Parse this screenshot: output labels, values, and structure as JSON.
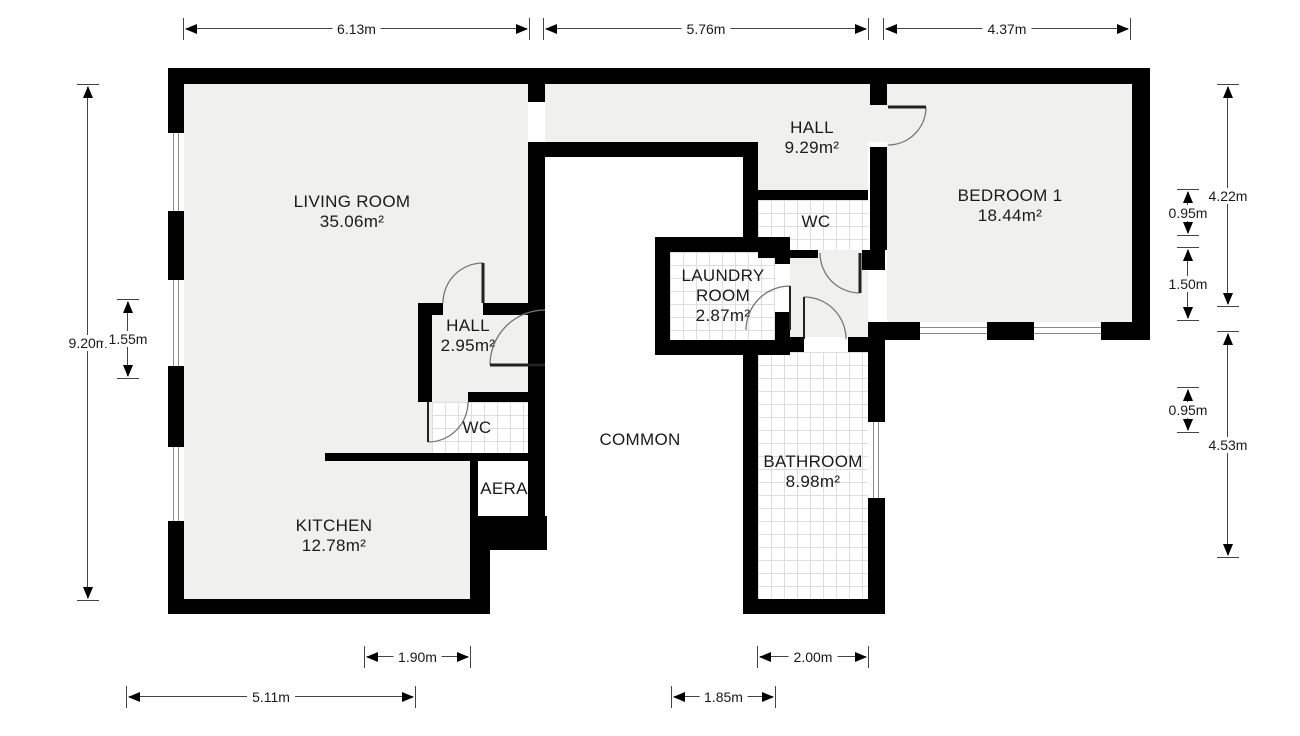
{
  "title": "Apartment floor plan",
  "rooms": [
    {
      "name": "LIVING ROOM",
      "lines": [
        "LIVING ROOM",
        "35.06m²"
      ],
      "x": 352,
      "y": 212
    },
    {
      "name": "HALL",
      "lines": [
        "HALL",
        "9.29m²"
      ],
      "x": 812,
      "y": 138
    },
    {
      "name": "BEDROOM 1",
      "lines": [
        "BEDROOM 1",
        "18.44m²"
      ],
      "x": 1010,
      "y": 206
    },
    {
      "name": "WC",
      "lines": [
        "WC"
      ],
      "x": 816,
      "y": 222
    },
    {
      "name": "LAUNDRY ROOM",
      "lines": [
        "LAUNDRY",
        "ROOM",
        "2.87m²"
      ],
      "x": 723,
      "y": 296
    },
    {
      "name": "HALL",
      "lines": [
        "HALL",
        "2.95m²"
      ],
      "x": 468,
      "y": 336
    },
    {
      "name": "WC",
      "lines": [
        "WC"
      ],
      "x": 477,
      "y": 428
    },
    {
      "name": "COMMON",
      "lines": [
        "COMMON"
      ],
      "x": 640,
      "y": 440
    },
    {
      "name": "AERA",
      "lines": [
        "AERA"
      ],
      "x": 504,
      "y": 489
    },
    {
      "name": "BATHROOM",
      "lines": [
        "BATHROOM",
        "8.98m²"
      ],
      "x": 813,
      "y": 472
    },
    {
      "name": "KITCHEN",
      "lines": [
        "KITCHEN",
        "12.78m²"
      ],
      "x": 334,
      "y": 536
    }
  ],
  "dimensions": {
    "top": [
      {
        "label": "6.13m",
        "x1": 184,
        "x2": 529,
        "y": 29
      },
      {
        "label": "5.76m",
        "x1": 544,
        "x2": 868,
        "y": 29
      },
      {
        "label": "4.37m",
        "x1": 884,
        "x2": 1130,
        "y": 29
      }
    ],
    "bottom": [
      {
        "label": "1.90m",
        "x1": 365,
        "x2": 470,
        "y": 657
      },
      {
        "label": "2.00m",
        "x1": 758,
        "x2": 868,
        "y": 657
      },
      {
        "label": "5.11m",
        "x1": 127,
        "x2": 415,
        "y": 697
      },
      {
        "label": "1.85m",
        "x1": 672,
        "x2": 775,
        "y": 697
      }
    ],
    "left": [
      {
        "label": "9.20m",
        "x": 88,
        "y1": 85,
        "y2": 600
      },
      {
        "label": "1.55m",
        "x": 128,
        "y1": 300,
        "y2": 378
      }
    ],
    "right": [
      {
        "label": "4.22m",
        "x": 1228,
        "y1": 85,
        "y2": 306
      },
      {
        "label": "0.95m",
        "x": 1188,
        "y1": 190,
        "y2": 235
      },
      {
        "label": "1.50m",
        "x": 1188,
        "y1": 248,
        "y2": 320
      },
      {
        "label": "0.95m",
        "x": 1188,
        "y1": 388,
        "y2": 432
      },
      {
        "label": "4.53m",
        "x": 1228,
        "y1": 332,
        "y2": 557
      }
    ]
  },
  "colors": {
    "wall": "#000000",
    "room_fill": "#f0f0ee",
    "tile_line": "#dedede",
    "dim_line": "#444444"
  }
}
